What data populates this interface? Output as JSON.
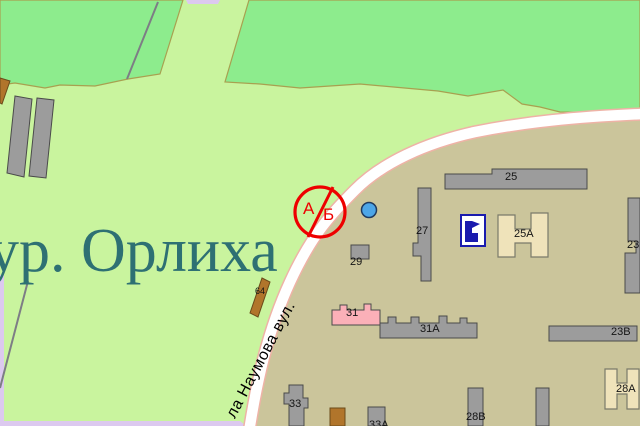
{
  "map": {
    "labels": {
      "area": "ур. Орлиха",
      "street": "ла Наумова вул."
    },
    "billboard_sign": {
      "top_letter": "А",
      "bottom_letter": "Б"
    },
    "buildings": [
      {
        "label": "25"
      },
      {
        "label": "27"
      },
      {
        "label": "29"
      },
      {
        "label": "25А"
      },
      {
        "label": "23Б"
      },
      {
        "label": "23В"
      },
      {
        "label": "31"
      },
      {
        "label": "31А"
      },
      {
        "label": "33"
      },
      {
        "label": "33А"
      },
      {
        "label": "28В"
      },
      {
        "label": "28А"
      },
      {
        "label": "64"
      }
    ],
    "icons": {
      "billboard_sign": "red-crossed-circle",
      "poi_marker": "blue-dot",
      "institution": "navy-building-pictogram"
    },
    "colors": {
      "field_green": "#c9f49e",
      "forest_green": "#8dec8d",
      "forest_border": "#a8a050",
      "urban_tan": "#cbc59b",
      "road_white": "#ffffff",
      "road_casing": "#eeb3a6",
      "road_secondary_lavender": "#dcc9ef",
      "building_gray": "#9c9c9c",
      "building_outline": "#4a4a4a",
      "building_beige": "#efe3ba",
      "building_pink": "#fbb0b8",
      "building_brown": "#b1752b",
      "path_gray": "#7d7d85",
      "sign_red": "#ee0000",
      "poi_blue": "#4da6e8",
      "icon_navy": "#1a1aae",
      "area_label_teal": "#2e7073"
    }
  }
}
